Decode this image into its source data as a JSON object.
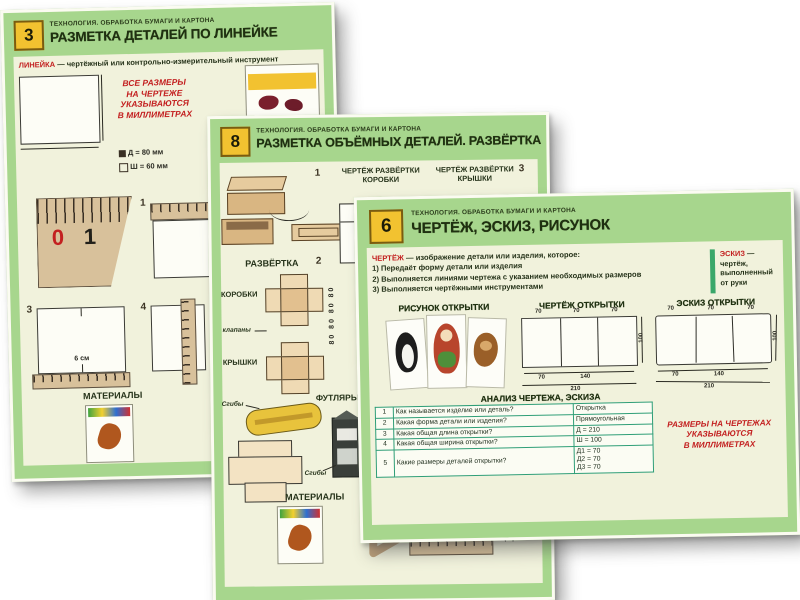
{
  "colors": {
    "frame_green": "#a7d68d",
    "cream": "#f1f2dc",
    "badge_yellow": "#f2c230",
    "accent_red": "#c32020",
    "table_teal": "#2f9e77",
    "cardboard_tan": "#d8c19b"
  },
  "poster3": {
    "number": "3",
    "series": "ТЕХНОЛОГИЯ. ОБРАБОТКА БУМАГИ И КАРТОНА",
    "title": "РАЗМЕТКА ДЕТАЛЕЙ ПО ЛИНЕЙКЕ",
    "definition_term": "ЛИНЕЙКА",
    "definition_text": "— чертёжный или контрольно-измерительный инструмент",
    "note_lines": [
      "ВСЕ РАЗМЕРЫ",
      "НА ЧЕРТЕЖЕ",
      "УКАЗЫВАЮТСЯ",
      "В МИЛЛИМЕТРАХ"
    ],
    "dim_length": "Д = 80 мм",
    "dim_width": "Ш = 60 мм",
    "ruler_zero": "0",
    "ruler_one": "1",
    "step1": "1",
    "step3": "3",
    "step4": "4",
    "size_label": "6 см",
    "materials_label": "МАТЕРИАЛЫ"
  },
  "poster8": {
    "number": "8",
    "series": "ТЕХНОЛОГИЯ. ОБРАБОТКА БУМАГИ И КАРТОНА",
    "title": "РАЗМЕТКА ОБЪЁМНЫХ ДЕТАЛЕЙ. РАЗВЁРТКА",
    "step1": "1",
    "step2": "2",
    "step3": "3",
    "label_drawing_box": "ЧЕРТЁЖ РАЗВЁРТКИ КОРОБКИ",
    "label_drawing_lid": "ЧЕРТЁЖ РАЗВЁРТКИ КРЫШКИ",
    "label_unfold": "РАЗВЁРТКА",
    "label_box": "КОРОБКИ",
    "label_lid": "КРЫШКИ",
    "label_flaps": "клапаны",
    "label_cases": "ФУТЛЯРЫ",
    "label_folds": "Сгибы",
    "dims_vertical": "80 80 80 80",
    "materials_label": "МАТЕРИАЛЫ"
  },
  "poster6": {
    "number": "6",
    "series": "ТЕХНОЛОГИЯ. ОБРАБОТКА БУМАГИ И КАРТОНА",
    "title": "ЧЕРТЁЖ, ЭСКИЗ, РИСУНОК",
    "def_term": "ЧЕРТЁЖ",
    "def_intro": "— изображение детали или изделия, которое:",
    "def_items": [
      "1) Передаёт форму детали или изделия",
      "2) Выполняется линиями чертежа с указанием необходимых размеров",
      "3) Выполняется чертёжными инструментами"
    ],
    "sketch_term": "ЭСКИЗ",
    "sketch_text": "— чертёж, выполненный от руки",
    "col_drawing": "РИСУНОК ОТКРЫТКИ",
    "col_blueprint": "ЧЕРТЁЖ ОТКРЫТКИ",
    "col_sketch": "ЭСКИЗ ОТКРЫТКИ",
    "dims_top": [
      "70",
      "70",
      "70"
    ],
    "dims_bottom": [
      "70",
      "140"
    ],
    "dim_total": "210",
    "dim_height": "100",
    "table_title": "АНАЛИЗ ЧЕРТЕЖА, ЭСКИЗА",
    "table_rows": [
      {
        "n": "1",
        "q": "Как называется изделие или деталь?",
        "a": "Открытка"
      },
      {
        "n": "2",
        "q": "Какая форма детали или изделия?",
        "a": "Прямоугольная"
      },
      {
        "n": "3",
        "q": "Какая общая длина открытки?",
        "a": "Д = 210"
      },
      {
        "n": "4",
        "q": "Какая общая ширина открытки?",
        "a": "Ш = 100"
      },
      {
        "n": "5",
        "q": "Какие размеры деталей открытки?",
        "a": ""
      }
    ],
    "row5_answers": [
      "Д1 = 70",
      "Д2 = 70",
      "Д3 = 70"
    ],
    "note_lines": [
      "РАЗМЕРЫ НА ЧЕРТЕЖАХ",
      "УКАЗЫВАЮТСЯ",
      "В МИЛЛИМЕТРАХ"
    ]
  }
}
